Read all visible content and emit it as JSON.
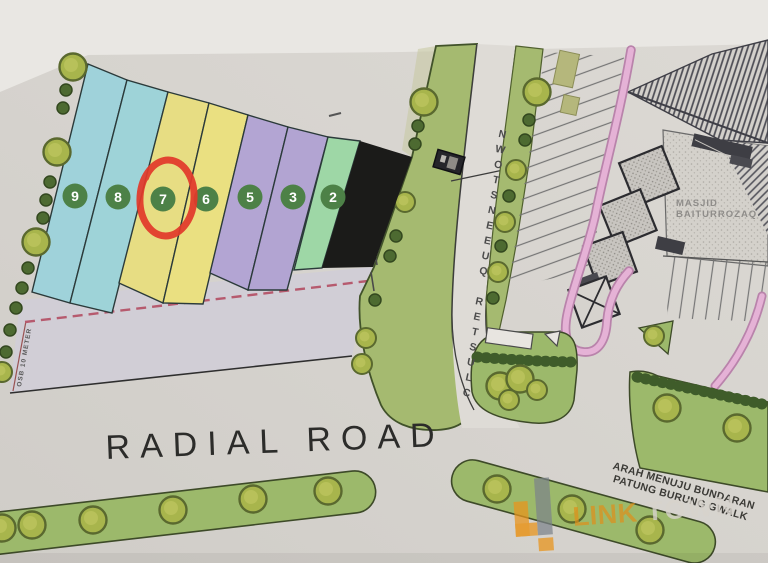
{
  "map": {
    "plots": [
      {
        "number": "9",
        "color": "#9fd2da"
      },
      {
        "number": "8",
        "color": "#9ed3d8"
      },
      {
        "number": "7",
        "color": "#e7dd83"
      },
      {
        "number": "6",
        "color": "#eae081"
      },
      {
        "number": "5",
        "color": "#b3a5d3"
      },
      {
        "number": "3",
        "color": "#b2a4d2"
      },
      {
        "number": "2",
        "color": "#9ed7a6"
      },
      {
        "number": "",
        "color": "#1b1b19"
      }
    ],
    "number_badge_color": "#4d8147",
    "highlight_color": "#e23a2b",
    "labels": {
      "vertical_road": "CLUSTER QUEENSTOWN",
      "main_road": "RADIAL ROAD",
      "mosque_line1": "MASJID",
      "mosque_line2": "BAITURROZAQ",
      "direction_line1": "ARAH MENUJU BUNDARAN",
      "direction_line2": "PATUNG BURUNG GWALK",
      "setback": "OSB 10 METER"
    },
    "watermark": {
      "brand_left": "LINK",
      "brand_right": "TOWN"
    }
  }
}
